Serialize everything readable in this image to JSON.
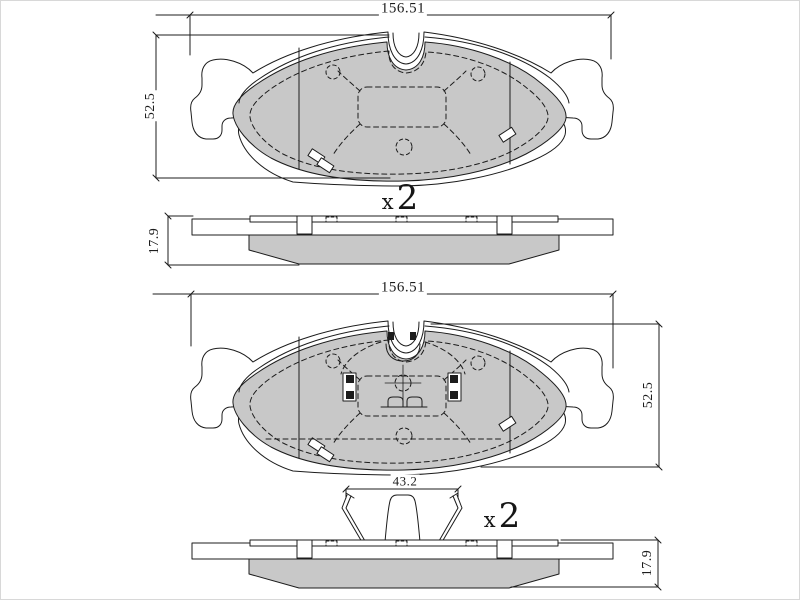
{
  "drawing": {
    "title_hint": "brake pad set technical drawing",
    "colors": {
      "line": "#1c1c1c",
      "friction_fill": "#c8c8c8",
      "background": "#ffffff",
      "frame_border": "#d8d8d8"
    },
    "labels": {
      "top_assembly": {
        "width_dim": "156.51",
        "height_dim": "52.5",
        "thickness_dim": "17.9",
        "qty_prefix": "x",
        "qty_value": "2"
      },
      "bottom_assembly": {
        "width_dim": "156.51",
        "height_dim": "52.5",
        "clip_width_dim": "43.2",
        "thickness_dim": "17.9",
        "qty_prefix": "x",
        "qty_value": "2"
      }
    }
  }
}
